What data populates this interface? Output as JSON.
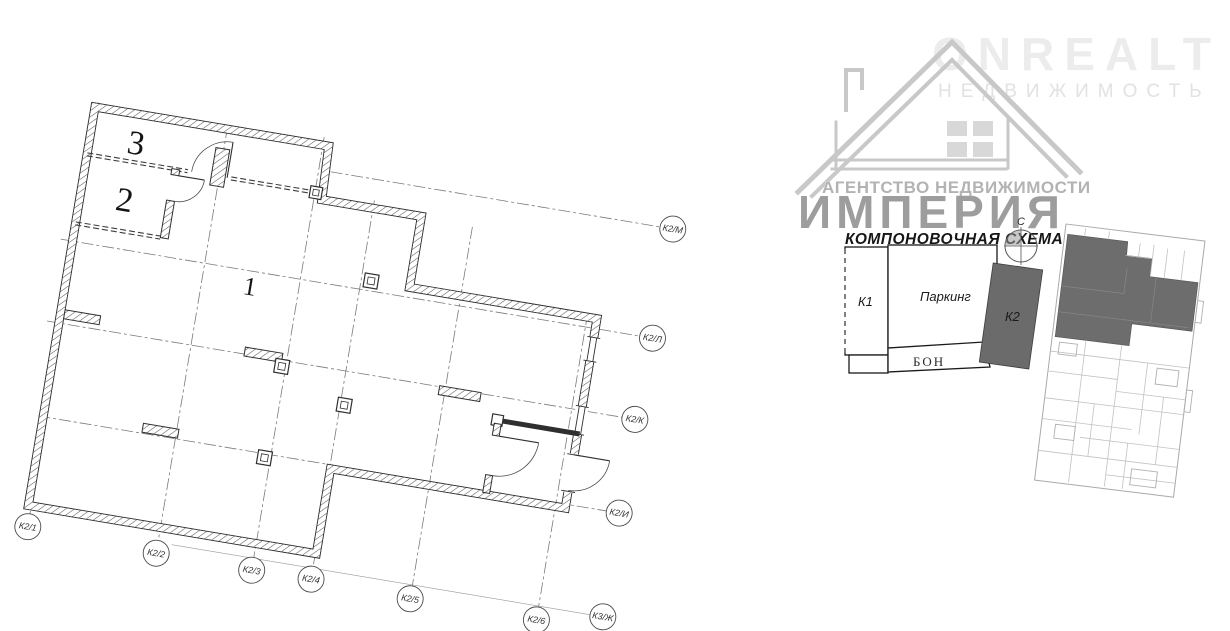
{
  "watermark": {
    "brand": "ONREALT",
    "brand_subtitle": "НЕДВИЖИМОСТЬ",
    "agency_line": "АГЕНТСТВО НЕДВИЖИМОСТИ",
    "agency_name": "ИМПЕРИЯ"
  },
  "floor_plan": {
    "room_labels": [
      "1",
      "2",
      "3"
    ],
    "axis_markers_bottom": [
      "К2/1",
      "К2/2",
      "К2/3",
      "К2/4",
      "К2/5",
      "К2/6"
    ],
    "axis_markers_right": [
      "К2/И",
      "К2/К",
      "К2/Л",
      "К2/М"
    ],
    "axis_marker_diagonal": "К3/Ж"
  },
  "layout_scheme": {
    "title": "КОМПОНОВОЧНАЯ СХЕМА",
    "north_label": "С",
    "blocks": {
      "k1": "К1",
      "parking": "Паркинг",
      "k2": "К2",
      "bon": "БОН"
    }
  },
  "colors": {
    "highlight_fill": "#6b6b6b",
    "plan_line": "#2f2f2f",
    "grid_line": "#7a7a7a",
    "watermark_dark": "#9d9d9d",
    "watermark_light": "#ececec"
  }
}
